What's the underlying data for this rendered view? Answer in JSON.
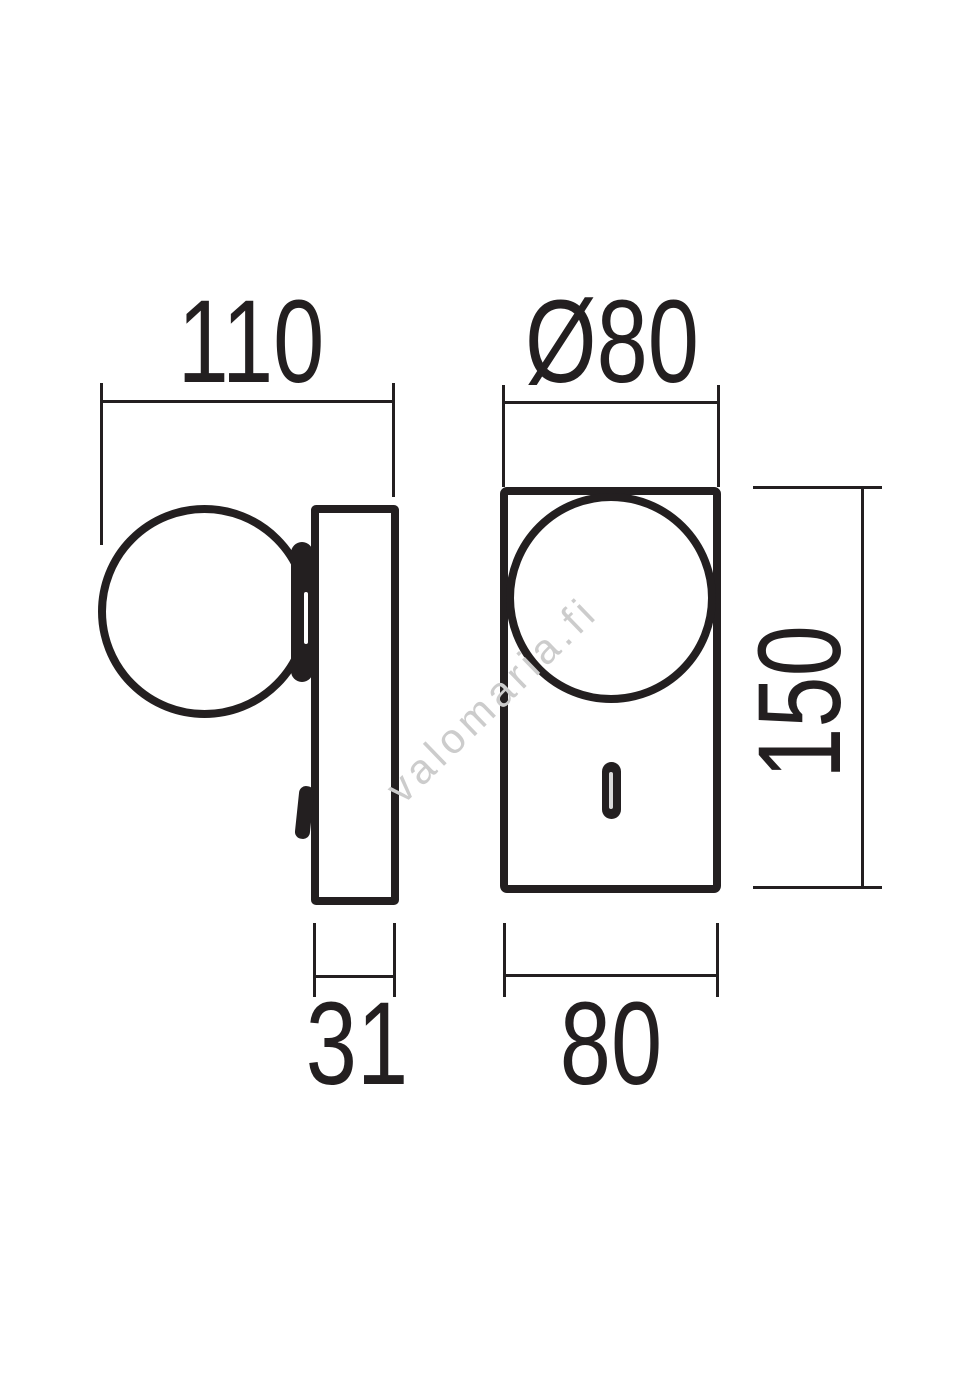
{
  "drawing": {
    "line_color": "#231f20",
    "watermark": {
      "text": "valomaria.fi",
      "color": "#cccccc"
    },
    "side_view": {
      "width_dim": "110",
      "depth_dim": "31"
    },
    "front_view": {
      "diameter_dim": "Ø80",
      "width_dim": "80",
      "height_dim": "150"
    }
  }
}
